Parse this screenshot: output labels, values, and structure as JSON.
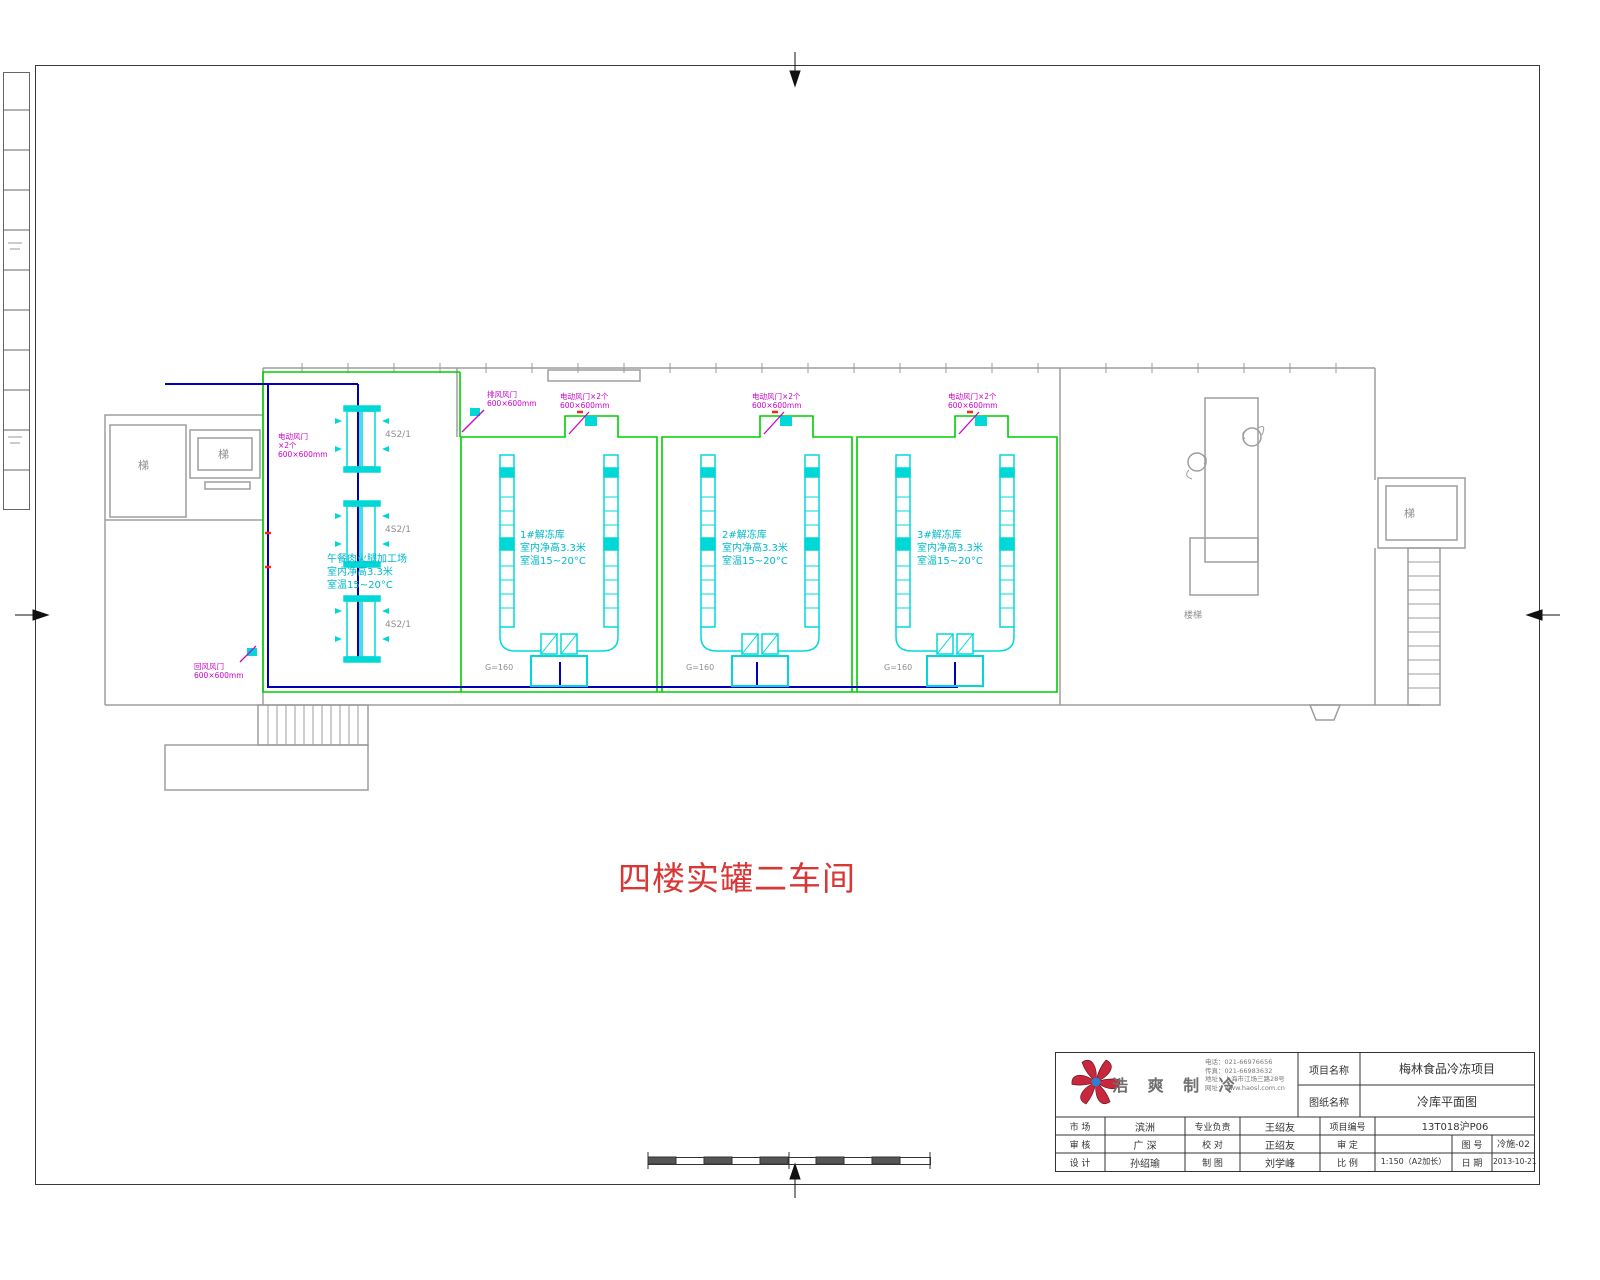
{
  "drawing_title": "四楼实罐二车间",
  "plan": {
    "processing_room": {
      "name": "午餐肉火腿加工场",
      "height": "室内净高3.3米",
      "temp": "室温15~20°C"
    },
    "freezer_rooms": [
      {
        "name": "1#解冻库",
        "height": "室内净高3.3米",
        "temp": "室温15~20°C"
      },
      {
        "name": "2#解冻库",
        "height": "室内净高3.3米",
        "temp": "室温15~20°C"
      },
      {
        "name": "3#解冻库",
        "height": "室内净高3.3米",
        "temp": "室温15~20°C"
      }
    ],
    "stairs": {
      "left_a": "梯",
      "left_b": "梯",
      "right": "梯",
      "mid": "楼梯"
    },
    "fan_coil_label": "4S2/1",
    "duct_flow_label": "G=160",
    "vents": {
      "top": {
        "l1": "电动风门×2个",
        "l2": "600×600mm"
      },
      "corner": {
        "l1": "排风风门",
        "l2": "600×600mm"
      },
      "left": {
        "l1": "电动风门",
        "l2": "×2个",
        "l3": "600×600mm"
      },
      "bottom": {
        "l1": "回风风门",
        "l2": "600×600mm"
      }
    }
  },
  "titleblock": {
    "company_name": "浩 爽 制 冷",
    "contact": {
      "l1": "电话：021-66976656",
      "l2": "传真：021-66983632",
      "l3": "地址：上海市江场三路28号",
      "l4": "网址：www.haosl.com.cn"
    },
    "project_label": "项目名称",
    "project_value": "梅林食品冷冻项目",
    "drawing_label": "图纸名称",
    "drawing_value": "冷库平面图",
    "r1c1l": "市 场",
    "r1c1v": "滨洲",
    "r1c2l": "专业负责",
    "r1c2v": "王绍友",
    "r1c3l": "项目编号",
    "r1c3v": "13T018沪P06",
    "r2c1l": "审 核",
    "r2c1v": "广 深",
    "r2c2l": "校 对",
    "r2c2v": "正绍友",
    "r2c3l": "审 定",
    "r2c3v": "",
    "r2c4l": "图 号",
    "r2c4v": "冷施-02",
    "r3c1l": "设 计",
    "r3c1v": "孙绍瑜",
    "r3c2l": "制 图",
    "r3c2v": "刘学峰",
    "r3c3l": "比 例",
    "r3c3v": "1:150（A2加长）",
    "r3c4l": "日 期",
    "r3c4v": "2013-10-21"
  },
  "colors": {
    "wall": "#9d9d9d",
    "insulation_green": "#00cf00",
    "equipment_cyan": "#00d8d8",
    "annotation_magenta": "#cc00cc",
    "pipe_blue": "#0000b8",
    "title_red": "#d93636"
  }
}
